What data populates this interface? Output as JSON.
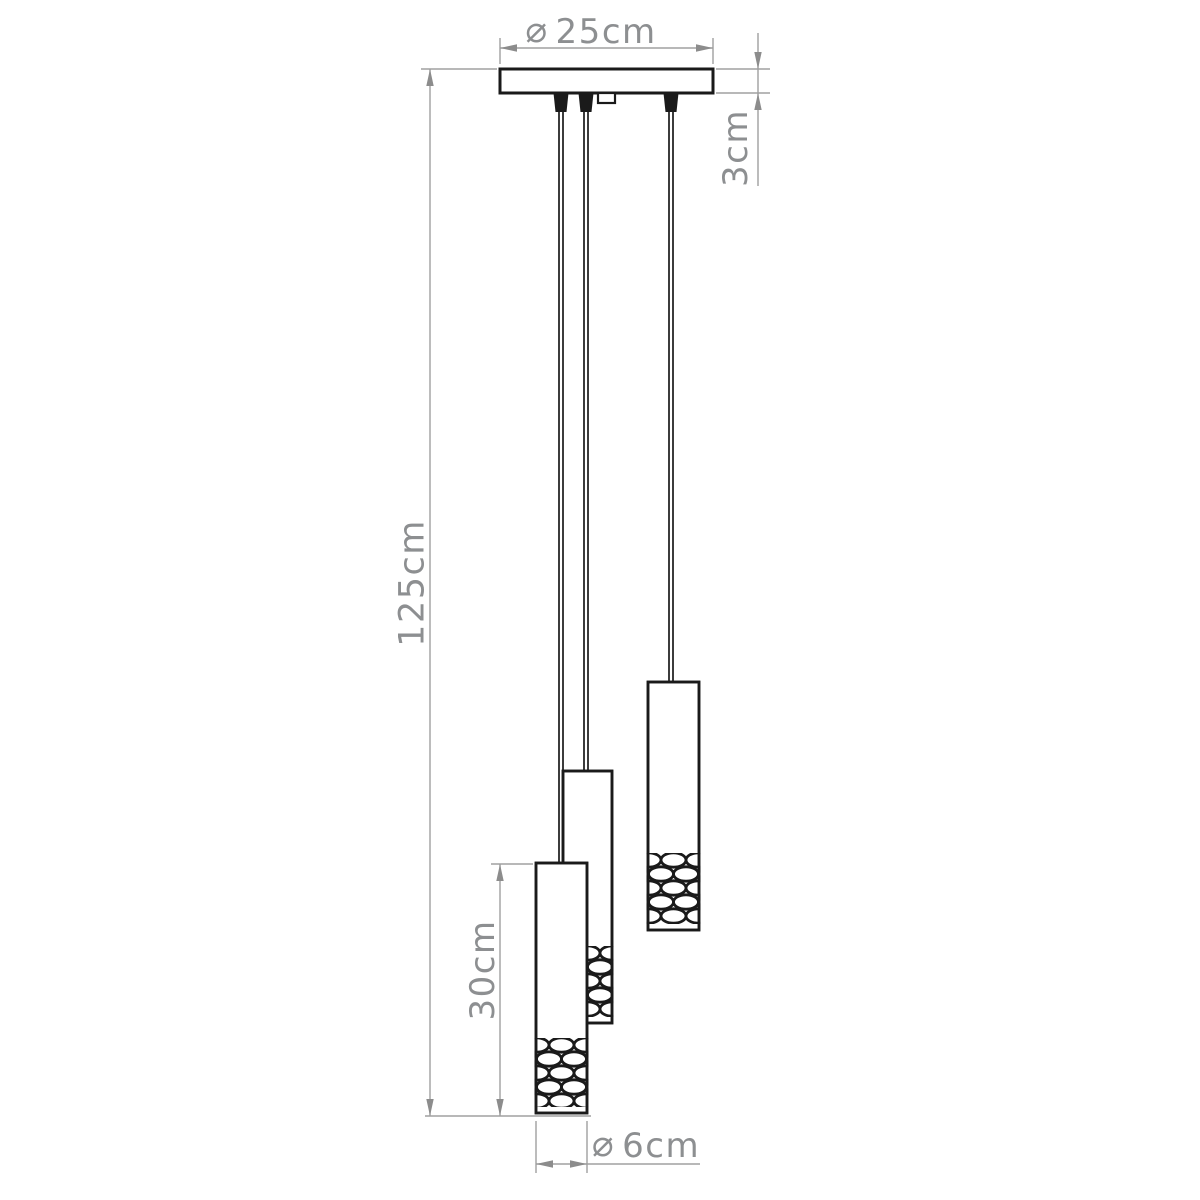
{
  "title": "Pendant lamp technical dimension drawing",
  "colors": {
    "outline": "#1a1a1a",
    "dimension_lines": "#a0a0a0",
    "dimension_text": "#8d8f91",
    "background": "#ffffff"
  },
  "fixture": {
    "type": "3-light cluster pendant",
    "canopy": "ceiling canopy plate",
    "cord_count": 3,
    "shade_count": 3,
    "shade_style": "cylinder with bubble-glass lower section"
  },
  "dimensions": {
    "canopy_diameter": {
      "symbol": "⌀",
      "value": "25cm"
    },
    "canopy_height": {
      "value": "3cm"
    },
    "overall_drop": {
      "value": "125cm"
    },
    "shade_height": {
      "value": "30cm"
    },
    "shade_diameter": {
      "symbol": "⌀",
      "value": "6cm"
    }
  }
}
